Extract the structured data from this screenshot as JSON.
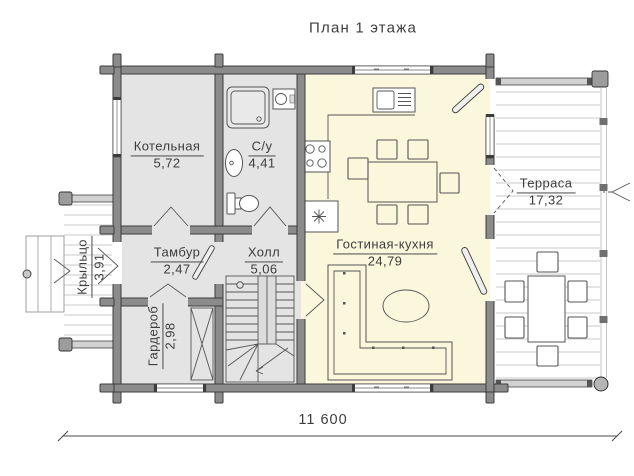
{
  "title": "План 1 этажа",
  "rooms": [
    {
      "name": "Котельная",
      "area": "5,72"
    },
    {
      "name": "С/у",
      "area": "4,41"
    },
    {
      "name": "Тамбур",
      "area": "2,47"
    },
    {
      "name": "Холл",
      "area": "5,06"
    },
    {
      "name": "Гардероб",
      "area": "2,98"
    },
    {
      "name": "Гостиная-кухня",
      "area": "24,79"
    },
    {
      "name": "Терраса",
      "area": "17,32"
    },
    {
      "name": "Крыльцо",
      "area": "3,91"
    }
  ],
  "dimension": {
    "overall_width": "11 600"
  },
  "colors": {
    "wall_fill": "#8b8b8b",
    "wall_outline": "#3c3c3c",
    "room_floor": "#e4e4e4",
    "living_kitchen_floor": "#faf7dc",
    "deck_line": "#b8b8b8",
    "line_art": "#555555",
    "text": "#3d3d3d"
  },
  "fixtures": [
    "shower",
    "washbasin",
    "wall-sink",
    "toilet",
    "kitchen-sink",
    "stove",
    "fireplace",
    "dining-table",
    "dining-chair",
    "sofa",
    "coffee-table",
    "staircase",
    "wardrobe-closet",
    "terrace-table",
    "terrace-chair",
    "porch-steps",
    "entry-arrow"
  ]
}
